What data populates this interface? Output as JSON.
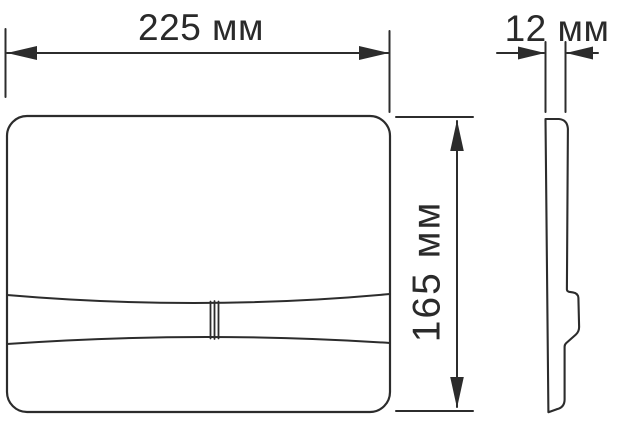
{
  "drawing": {
    "dimensions": {
      "width": {
        "label": "225 мм",
        "value": 225,
        "unit": "мм"
      },
      "thickness": {
        "label": "12 мм",
        "value": 12,
        "unit": "мм"
      },
      "height": {
        "label": "165 мм",
        "value": 165,
        "unit": "мм"
      }
    },
    "colors": {
      "line": "#2c2c2c",
      "text": "#2a2a2a",
      "background": "#ffffff"
    }
  }
}
